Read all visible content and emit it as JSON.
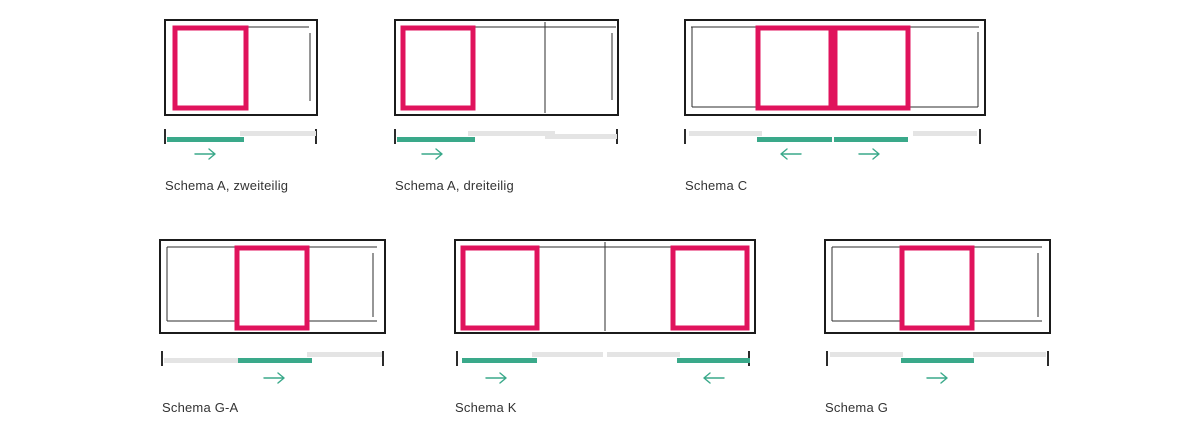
{
  "page": {
    "width": 1200,
    "height": 429,
    "background": "#ffffff"
  },
  "colors": {
    "frame": "#1b1b1b",
    "thin_line": "#2e2e2e",
    "panel": "#e0135c",
    "track_green": "#3aa98a",
    "track_gray": "#e4e4e4",
    "tick": "#2b2b2b",
    "arrow": "#3aa98a",
    "label": "#333333"
  },
  "schemas": [
    {
      "id": "a-zweiteilig",
      "label": "Schema A, zweiteilig",
      "origin": {
        "left": 160,
        "top": 15
      },
      "frame": {
        "x": 5,
        "y": 5,
        "w": 152,
        "h": 95
      },
      "panels": [
        [
          15,
          13,
          71,
          80
        ]
      ],
      "lines": [
        [
          86,
          12,
          149,
          12
        ],
        [
          150,
          18,
          150,
          86
        ]
      ],
      "ticks": {
        "xs": [
          5,
          156
        ],
        "y1": 114,
        "y2": 129
      },
      "bars": [
        [
          80,
          116,
          76,
          "gray"
        ],
        [
          7,
          122,
          77,
          "green"
        ]
      ],
      "arrows": [
        {
          "cx": 46,
          "cy": 139,
          "dir": "right"
        }
      ],
      "label_pos": {
        "x": 5,
        "y": 164
      }
    },
    {
      "id": "a-dreiteilig",
      "label": "Schema A, dreiteilig",
      "origin": {
        "left": 390,
        "top": 15
      },
      "frame": {
        "x": 5,
        "y": 5,
        "w": 223,
        "h": 95
      },
      "panels": [
        [
          13,
          13,
          70,
          80
        ]
      ],
      "lines": [
        [
          83,
          12,
          226,
          12
        ],
        [
          155,
          7,
          155,
          98
        ],
        [
          222,
          18,
          222,
          85
        ]
      ],
      "ticks": {
        "xs": [
          5,
          227
        ],
        "y1": 114,
        "y2": 129
      },
      "bars": [
        [
          78,
          116,
          87,
          "gray"
        ],
        [
          155,
          119,
          72,
          "gray"
        ],
        [
          7,
          122,
          78,
          "green"
        ]
      ],
      "arrows": [
        {
          "cx": 43,
          "cy": 139,
          "dir": "right"
        }
      ],
      "label_pos": {
        "x": 5,
        "y": 164
      }
    },
    {
      "id": "c",
      "label": "Schema C",
      "origin": {
        "left": 680,
        "top": 15
      },
      "frame": {
        "x": 5,
        "y": 5,
        "w": 300,
        "h": 95
      },
      "panels": [
        [
          78,
          13,
          73,
          80
        ],
        [
          155,
          13,
          73,
          80
        ]
      ],
      "lines": [
        [
          11,
          12,
          299,
          12
        ],
        [
          12,
          12,
          12,
          92
        ],
        [
          12,
          92,
          298,
          92
        ],
        [
          298,
          17,
          298,
          92
        ]
      ],
      "ticks": {
        "xs": [
          5,
          300
        ],
        "y1": 114,
        "y2": 129
      },
      "bars": [
        [
          9,
          116,
          73,
          "gray"
        ],
        [
          233,
          116,
          64,
          "gray"
        ],
        [
          77,
          122,
          75,
          "green"
        ],
        [
          154,
          122,
          74,
          "green"
        ]
      ],
      "arrows": [
        {
          "cx": 110,
          "cy": 139,
          "dir": "left"
        },
        {
          "cx": 190,
          "cy": 139,
          "dir": "right"
        }
      ],
      "label_pos": {
        "x": 5,
        "y": 164
      }
    },
    {
      "id": "g-a",
      "label": "Schema G-A",
      "origin": {
        "left": 155,
        "top": 235
      },
      "frame": {
        "x": 5,
        "y": 5,
        "w": 225,
        "h": 93
      },
      "panels": [
        [
          82,
          13,
          70,
          80
        ]
      ],
      "lines": [
        [
          12,
          12,
          222,
          12
        ],
        [
          12,
          12,
          12,
          86
        ],
        [
          12,
          86,
          222,
          86
        ],
        [
          218,
          18,
          218,
          82
        ]
      ],
      "ticks": {
        "xs": [
          7,
          228
        ],
        "y1": 116,
        "y2": 131
      },
      "bars": [
        [
          9,
          123,
          74,
          "gray"
        ],
        [
          152,
          117,
          75,
          "gray"
        ],
        [
          83,
          123,
          74,
          "green"
        ]
      ],
      "arrows": [
        {
          "cx": 120,
          "cy": 143,
          "dir": "right"
        }
      ],
      "label_pos": {
        "x": 7,
        "y": 166
      }
    },
    {
      "id": "k",
      "label": "Schema K",
      "origin": {
        "left": 450,
        "top": 235
      },
      "frame": {
        "x": 5,
        "y": 5,
        "w": 300,
        "h": 93
      },
      "panels": [
        [
          13,
          13,
          74,
          80
        ],
        [
          223,
          13,
          74,
          80
        ]
      ],
      "lines": [
        [
          87,
          12,
          223,
          12
        ],
        [
          155,
          7,
          155,
          96
        ]
      ],
      "ticks": {
        "xs": [
          7,
          299
        ],
        "y1": 116,
        "y2": 131
      },
      "bars": [
        [
          82,
          117,
          71,
          "gray"
        ],
        [
          157,
          117,
          73,
          "gray"
        ],
        [
          12,
          123,
          75,
          "green"
        ],
        [
          227,
          123,
          73,
          "green"
        ]
      ],
      "arrows": [
        {
          "cx": 47,
          "cy": 143,
          "dir": "right"
        },
        {
          "cx": 263,
          "cy": 143,
          "dir": "left"
        }
      ],
      "label_pos": {
        "x": 5,
        "y": 166
      }
    },
    {
      "id": "g",
      "label": "Schema G",
      "origin": {
        "left": 820,
        "top": 235
      },
      "frame": {
        "x": 5,
        "y": 5,
        "w": 225,
        "h": 93
      },
      "panels": [
        [
          82,
          13,
          70,
          80
        ]
      ],
      "lines": [
        [
          12,
          12,
          222,
          12
        ],
        [
          12,
          12,
          12,
          86
        ],
        [
          12,
          86,
          222,
          86
        ],
        [
          218,
          18,
          218,
          82
        ]
      ],
      "ticks": {
        "xs": [
          7,
          228
        ],
        "y1": 116,
        "y2": 131
      },
      "bars": [
        [
          10,
          117,
          73,
          "gray"
        ],
        [
          153,
          117,
          73,
          "gray"
        ],
        [
          81,
          123,
          73,
          "green"
        ]
      ],
      "arrows": [
        {
          "cx": 118,
          "cy": 143,
          "dir": "right"
        }
      ],
      "label_pos": {
        "x": 5,
        "y": 166
      }
    }
  ]
}
